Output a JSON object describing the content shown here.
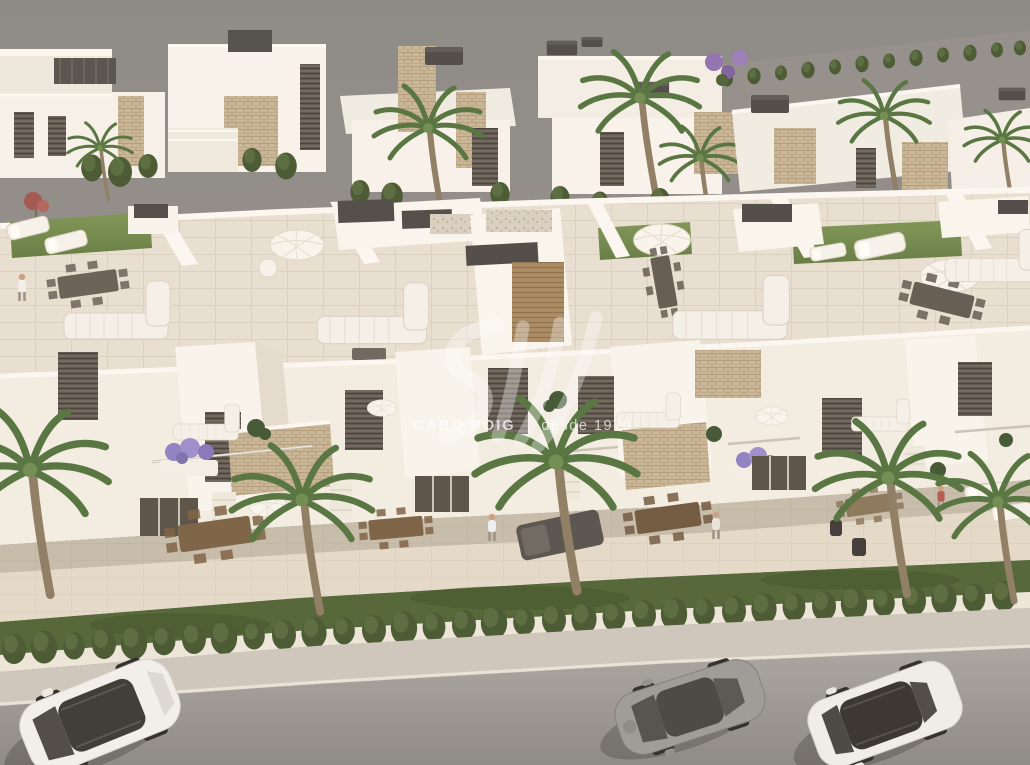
{
  "watermark": {
    "brand": "CABO ROIG",
    "separator": "|",
    "tagline": "desde 1970"
  },
  "image": {
    "kind": "3D architectural render",
    "subject": "Aerial view of a modern white Mediterranean villa development with rooftop solariums, terraces, landscaped gardens, palm trees, a trimmed hedge and a street with three parked cars",
    "palette": {
      "backdrop_gray": "#8e8a86",
      "building_white": "#f6f1e9",
      "building_shade": "#e3dbcd",
      "stone_cladding": "#c7b595",
      "rooftop_lawn": "#6f8a49",
      "garden_lawn": "#4e6233",
      "hedge_green": "#45552e",
      "terrace_tile": "#e8dfd0",
      "road_gray": "#9d9994",
      "sidewalk": "#cdc6bb",
      "dark_fixture": "#4b4743",
      "lavender": "#8d7fc2",
      "watermark": "#ffffff"
    },
    "cars": [
      {
        "position": "left",
        "body_color": "white",
        "type": "suv"
      },
      {
        "position": "center-right",
        "body_color": "gray",
        "type": "coupe"
      },
      {
        "position": "right",
        "body_color": "white",
        "type": "sedan"
      }
    ]
  }
}
